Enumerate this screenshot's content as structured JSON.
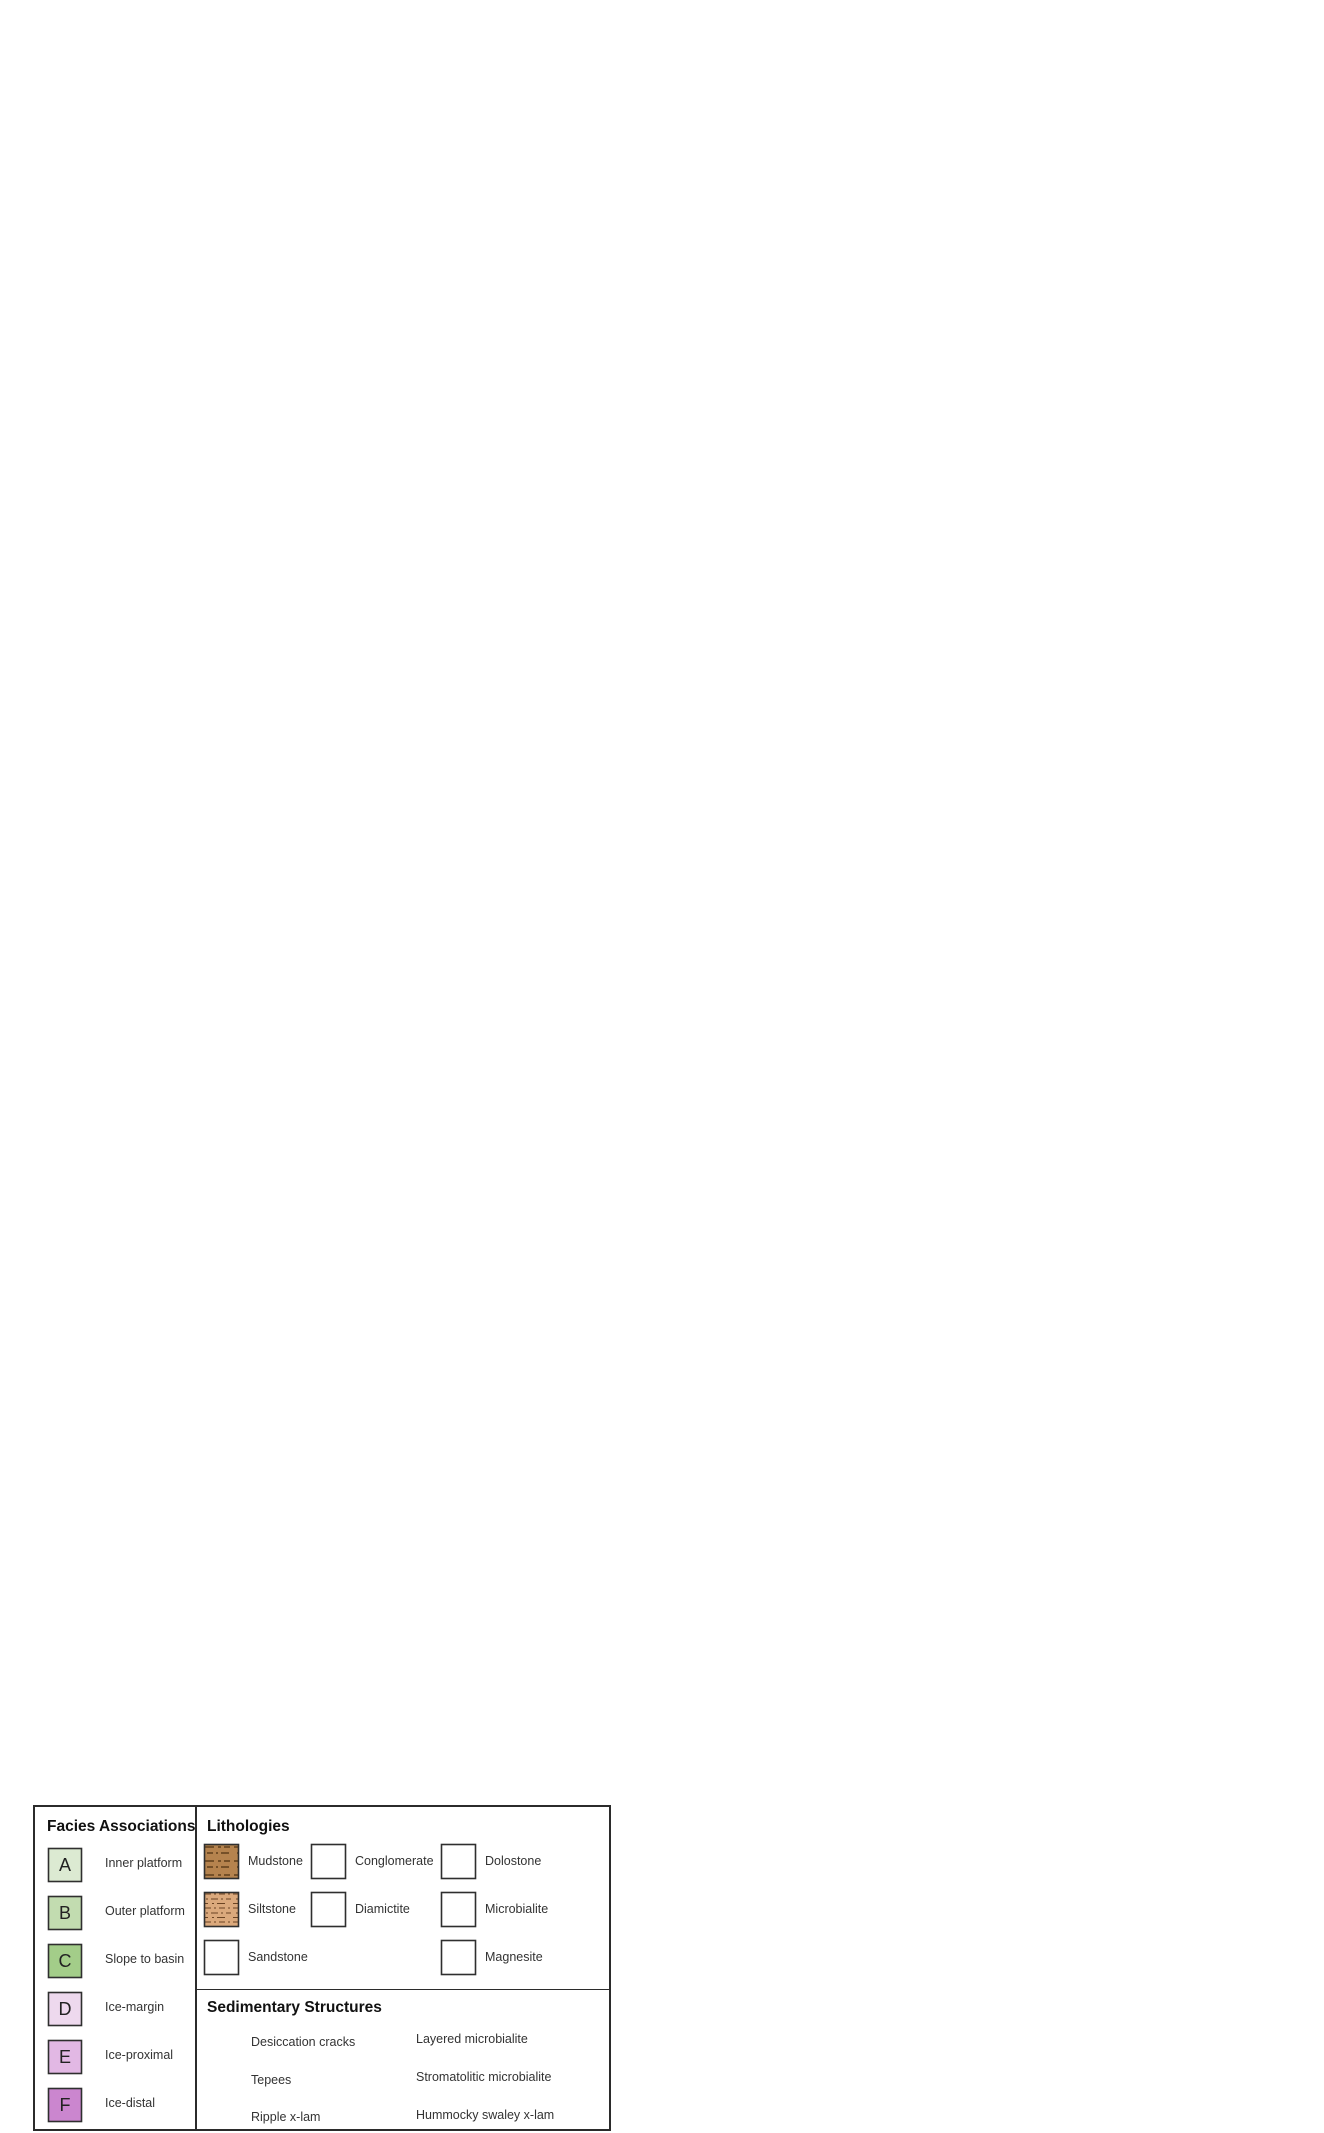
{
  "figure": {
    "top_block": {
      "label_fresh_water_1": "fresh water",
      "label_fresh_water_2": "input",
      "label_land": "land",
      "label_sea_level": "relative sea level"
    },
    "bottom_block": {
      "label_sea_level": "relative sea level"
    },
    "grain_axis": [
      "MUD",
      "SAND",
      "GRAVEL"
    ],
    "columns": [
      {
        "id": "A1",
        "title": "A1: supratidal to intertidal",
        "x": 487,
        "y": 88,
        "unit_w": 95,
        "layers": [
          [
            "siltstone",
            0.58,
            16
          ],
          [
            "magnesite",
            1.0,
            23
          ],
          [
            "microbialite",
            0.45,
            11
          ],
          [
            "magnesite",
            1.02,
            29
          ],
          [
            "dolostone",
            0.45,
            13
          ],
          [
            "magnesite",
            0.96,
            36
          ],
          [
            "dolostone",
            0.46,
            18
          ],
          [
            "magnesite",
            0.9,
            14
          ],
          [
            "dolostone",
            0.45,
            20
          ],
          [
            "siltstone_grey",
            0.52,
            17
          ]
        ]
      },
      {
        "id": "A2",
        "title": "A2: intertidal to subtidal",
        "x": 639,
        "y": 122,
        "unit_w": 95,
        "layers": [
          [
            "siltstone",
            0.6,
            12
          ],
          [
            "sandstone",
            0.82,
            37
          ],
          [
            "siltstone",
            0.62,
            29
          ],
          [
            "sandstone",
            0.72,
            21
          ],
          [
            "siltstone",
            0.62,
            41
          ],
          [
            "microbialite",
            0.64,
            40
          ]
        ]
      },
      {
        "id": "B1",
        "title": "B1: shallow subtidal",
        "x": 817,
        "y": 152,
        "unit_w": 75,
        "layers": [
          [
            "dolostone",
            0.55,
            10
          ],
          [
            "siltstone",
            0.52,
            58
          ],
          [
            "dolostone",
            0.55,
            14
          ],
          [
            "siltstone",
            0.5,
            7
          ],
          [
            "dolostone",
            0.55,
            12
          ],
          [
            "siltstone",
            0.52,
            19
          ],
          [
            "dolostone",
            0.55,
            14
          ],
          [
            "siltstone",
            0.52,
            42
          ],
          [
            "dolostone",
            0.55,
            16
          ]
        ]
      },
      {
        "id": "B2",
        "title": "B2: platform margin reef",
        "x": 958,
        "y": 178,
        "unit_w": 90,
        "layers": [
          [
            "siltstone",
            0.56,
            17
          ],
          [
            "microbialite",
            0.62,
            46
          ],
          [
            "sandstone",
            0.58,
            15
          ],
          [
            "dolostone",
            0.52,
            17
          ],
          [
            "microbialite",
            0.58,
            46
          ],
          [
            "dolostone",
            0.52,
            10
          ],
          [
            "microbialite",
            0.56,
            36
          ]
        ]
      },
      {
        "id": "C",
        "title": "C: slope to basin",
        "x": 1162,
        "y": 220,
        "unit_w": 85,
        "layers": [
          [
            "dolostone",
            0.6,
            10
          ],
          [
            "siltstone",
            0.58,
            12
          ],
          [
            "dolostone",
            0.62,
            30
          ],
          [
            "mudstone",
            0.52,
            60
          ],
          [
            "siltstone",
            0.48,
            7
          ],
          [
            "dolostone",
            0.55,
            9
          ],
          [
            "siltstone",
            0.48,
            5
          ],
          [
            "dolostone",
            0.55,
            9
          ],
          [
            "siltstone",
            0.48,
            5
          ],
          [
            "dolostone",
            0.58,
            11
          ]
        ]
      },
      {
        "id": "D",
        "title": "D: ice-margin",
        "x": 117,
        "y": 1402,
        "unit_w": 105,
        "layers": [
          [
            "diamictite",
            1.0,
            48
          ],
          [
            "siltstone",
            0.4,
            7
          ],
          [
            "diamictite",
            0.97,
            140
          ]
        ]
      },
      {
        "id": "E",
        "title": "E: ice-proximal",
        "x": 396,
        "y": 1458,
        "unit_w": 100,
        "layers": [
          [
            "diamictite",
            1.0,
            21
          ],
          [
            "siltstone",
            0.42,
            18
          ],
          [
            "diamictite",
            1.0,
            20
          ],
          [
            "sandstone",
            0.64,
            51
          ],
          [
            "diamictite",
            1.0,
            52
          ],
          [
            "sandstone",
            0.6,
            10
          ],
          [
            "diamictite",
            1.04,
            24
          ]
        ]
      },
      {
        "id": "F",
        "title": "F: ice-distal",
        "x": 720,
        "y": 1526,
        "unit_w": 105,
        "layers": [
          [
            "mudstone",
            0.42,
            50
          ],
          [
            "conglomerate",
            1.0,
            9
          ],
          [
            "sandstone",
            0.8,
            9
          ],
          [
            "mudstone",
            0.38,
            9
          ],
          [
            "sandstone",
            0.64,
            11
          ],
          [
            "conglomerate",
            1.05,
            11
          ],
          [
            "mudstone",
            0.4,
            46
          ],
          [
            "sandstone",
            0.78,
            9
          ],
          [
            "conglomerate",
            1.0,
            9
          ],
          [
            "siltstone",
            0.4,
            6
          ],
          [
            "sandstone",
            0.62,
            18
          ],
          [
            "conglomerate",
            1.06,
            14
          ]
        ]
      }
    ]
  },
  "legend": {
    "facies_header": "Facies Associations",
    "lithologies_header": "Lithologies",
    "structures_header": "Sedimentary Structures",
    "facies": [
      {
        "code": "A",
        "label": "Inner platform",
        "color": "#dcead2"
      },
      {
        "code": "B",
        "label": "Outer platform",
        "color": "#c2dcb0"
      },
      {
        "code": "C",
        "label": "Slope to basin",
        "color": "#a3cd89"
      },
      {
        "code": "D",
        "label": "Ice-margin",
        "color": "#eed9ee"
      },
      {
        "code": "E",
        "label": "Ice-proximal",
        "color": "#e2b8e4"
      },
      {
        "code": "F",
        "label": "Ice-distal",
        "color": "#cb86cf"
      }
    ],
    "lithologies": [
      {
        "name": "Mudstone"
      },
      {
        "name": "Siltstone"
      },
      {
        "name": "Sandstone"
      },
      {
        "name": "Conglomerate"
      },
      {
        "name": "Diamictite"
      },
      {
        "name": "Dolostone"
      },
      {
        "name": "Microbialite"
      },
      {
        "name": "Magnesite"
      }
    ],
    "structures": [
      {
        "name": "Desiccation cracks"
      },
      {
        "name": "Tepees"
      },
      {
        "name": "Ripple x-lam"
      },
      {
        "name": "Layered microbialite"
      },
      {
        "name": "Stromatolitic microbialite"
      },
      {
        "name": "Hummocky swaley x-lam"
      }
    ]
  },
  "colors": {
    "land_top": "#edd3b3",
    "land_face": "#c9b294",
    "river": "#d6e1eb",
    "inner_platform": "#dfecd4",
    "outer_platform": "#cfe4bd",
    "slope": "#a7cf8c",
    "platform_face": "#d8e7c9",
    "reef_mound": "#bdd8ec",
    "ice": "#ffffff",
    "ice_face": "#e7e7ea",
    "glacial_land_face": "#c8b396",
    "ice_proximal_floor": "#ddc1e4",
    "ice_distal_floor": "#ca8ed3",
    "ice_distal_face": "#bc74c6",
    "front_wedge": "#d09ad8",
    "ice_margin_lens": "#f0d9f0",
    "debris_lobe": "#b1884e"
  }
}
